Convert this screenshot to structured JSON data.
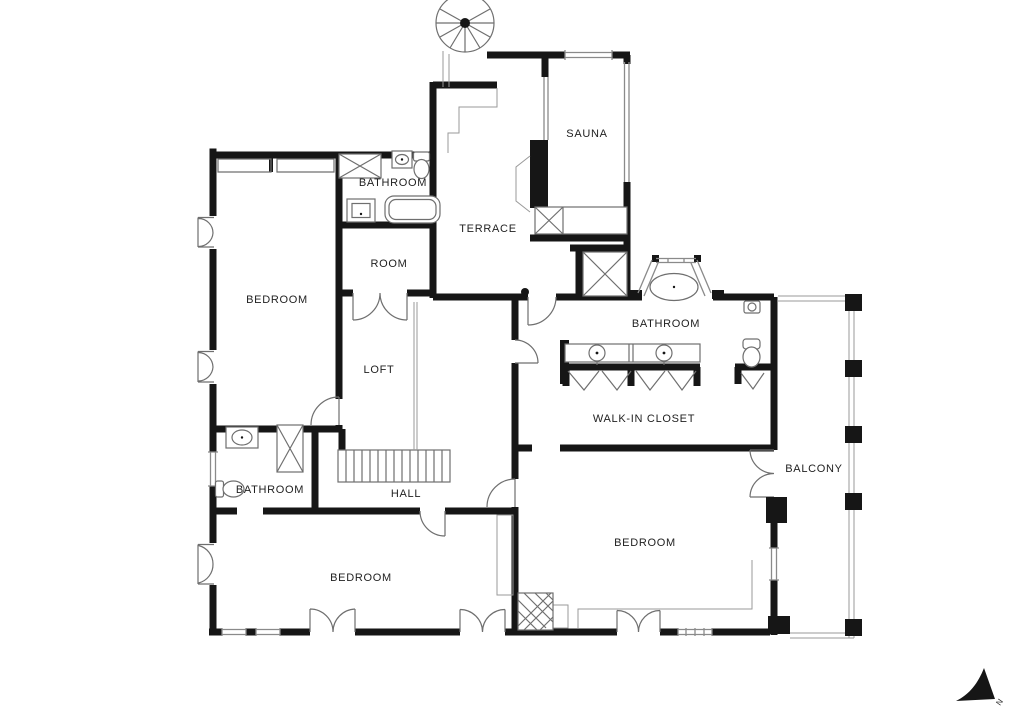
{
  "rooms": {
    "bedroom_top_left": {
      "label": "BEDROOM"
    },
    "bathroom_top": {
      "label": "BATHROOM"
    },
    "room": {
      "label": "ROOM"
    },
    "terrace": {
      "label": "TERRACE"
    },
    "sauna": {
      "label": "SAUNA"
    },
    "loft": {
      "label": "LOFT"
    },
    "bathroom_master": {
      "label": "BATHROOM"
    },
    "walk_in_closet": {
      "label": "WALK-IN CLOSET"
    },
    "balcony": {
      "label": "BALCONY"
    },
    "bathroom_lower": {
      "label": "BATHROOM"
    },
    "hall": {
      "label": "HALL"
    },
    "bedroom_lower_left": {
      "label": "BEDROOM"
    },
    "bedroom_right": {
      "label": "BEDROOM"
    }
  },
  "compass": {
    "north_label": "N"
  },
  "colors": {
    "wall": "#161616",
    "fixture_line": "#6f6f6f",
    "label_text": "#1f1f1f",
    "background": "#ffffff"
  },
  "fixture_icons": {
    "spiral-staircase-icon": "circular fan of treads",
    "staircase-icon": "straight run of parallel treads",
    "shower-icon": "square crossed with X",
    "elevator-shaft-icon": "large square crossed with X",
    "bathtub-icon": "rounded rectangle tub",
    "oval-bathtub-icon": "ellipse tub in bay window",
    "sink-icon": "round basin in rectangle",
    "toilet-icon": "tank with oval bowl",
    "wardrobe-icon": "V chevron",
    "fireplace-icon": "cross-hatched square",
    "column-icon": "solid black square",
    "door-icon": "quarter-circle swing arc",
    "double-door-icon": "two quarter-circle swing arcs",
    "window-icon": "double parallel lines",
    "north-arrow-icon": "solid fin pointing south-east"
  }
}
